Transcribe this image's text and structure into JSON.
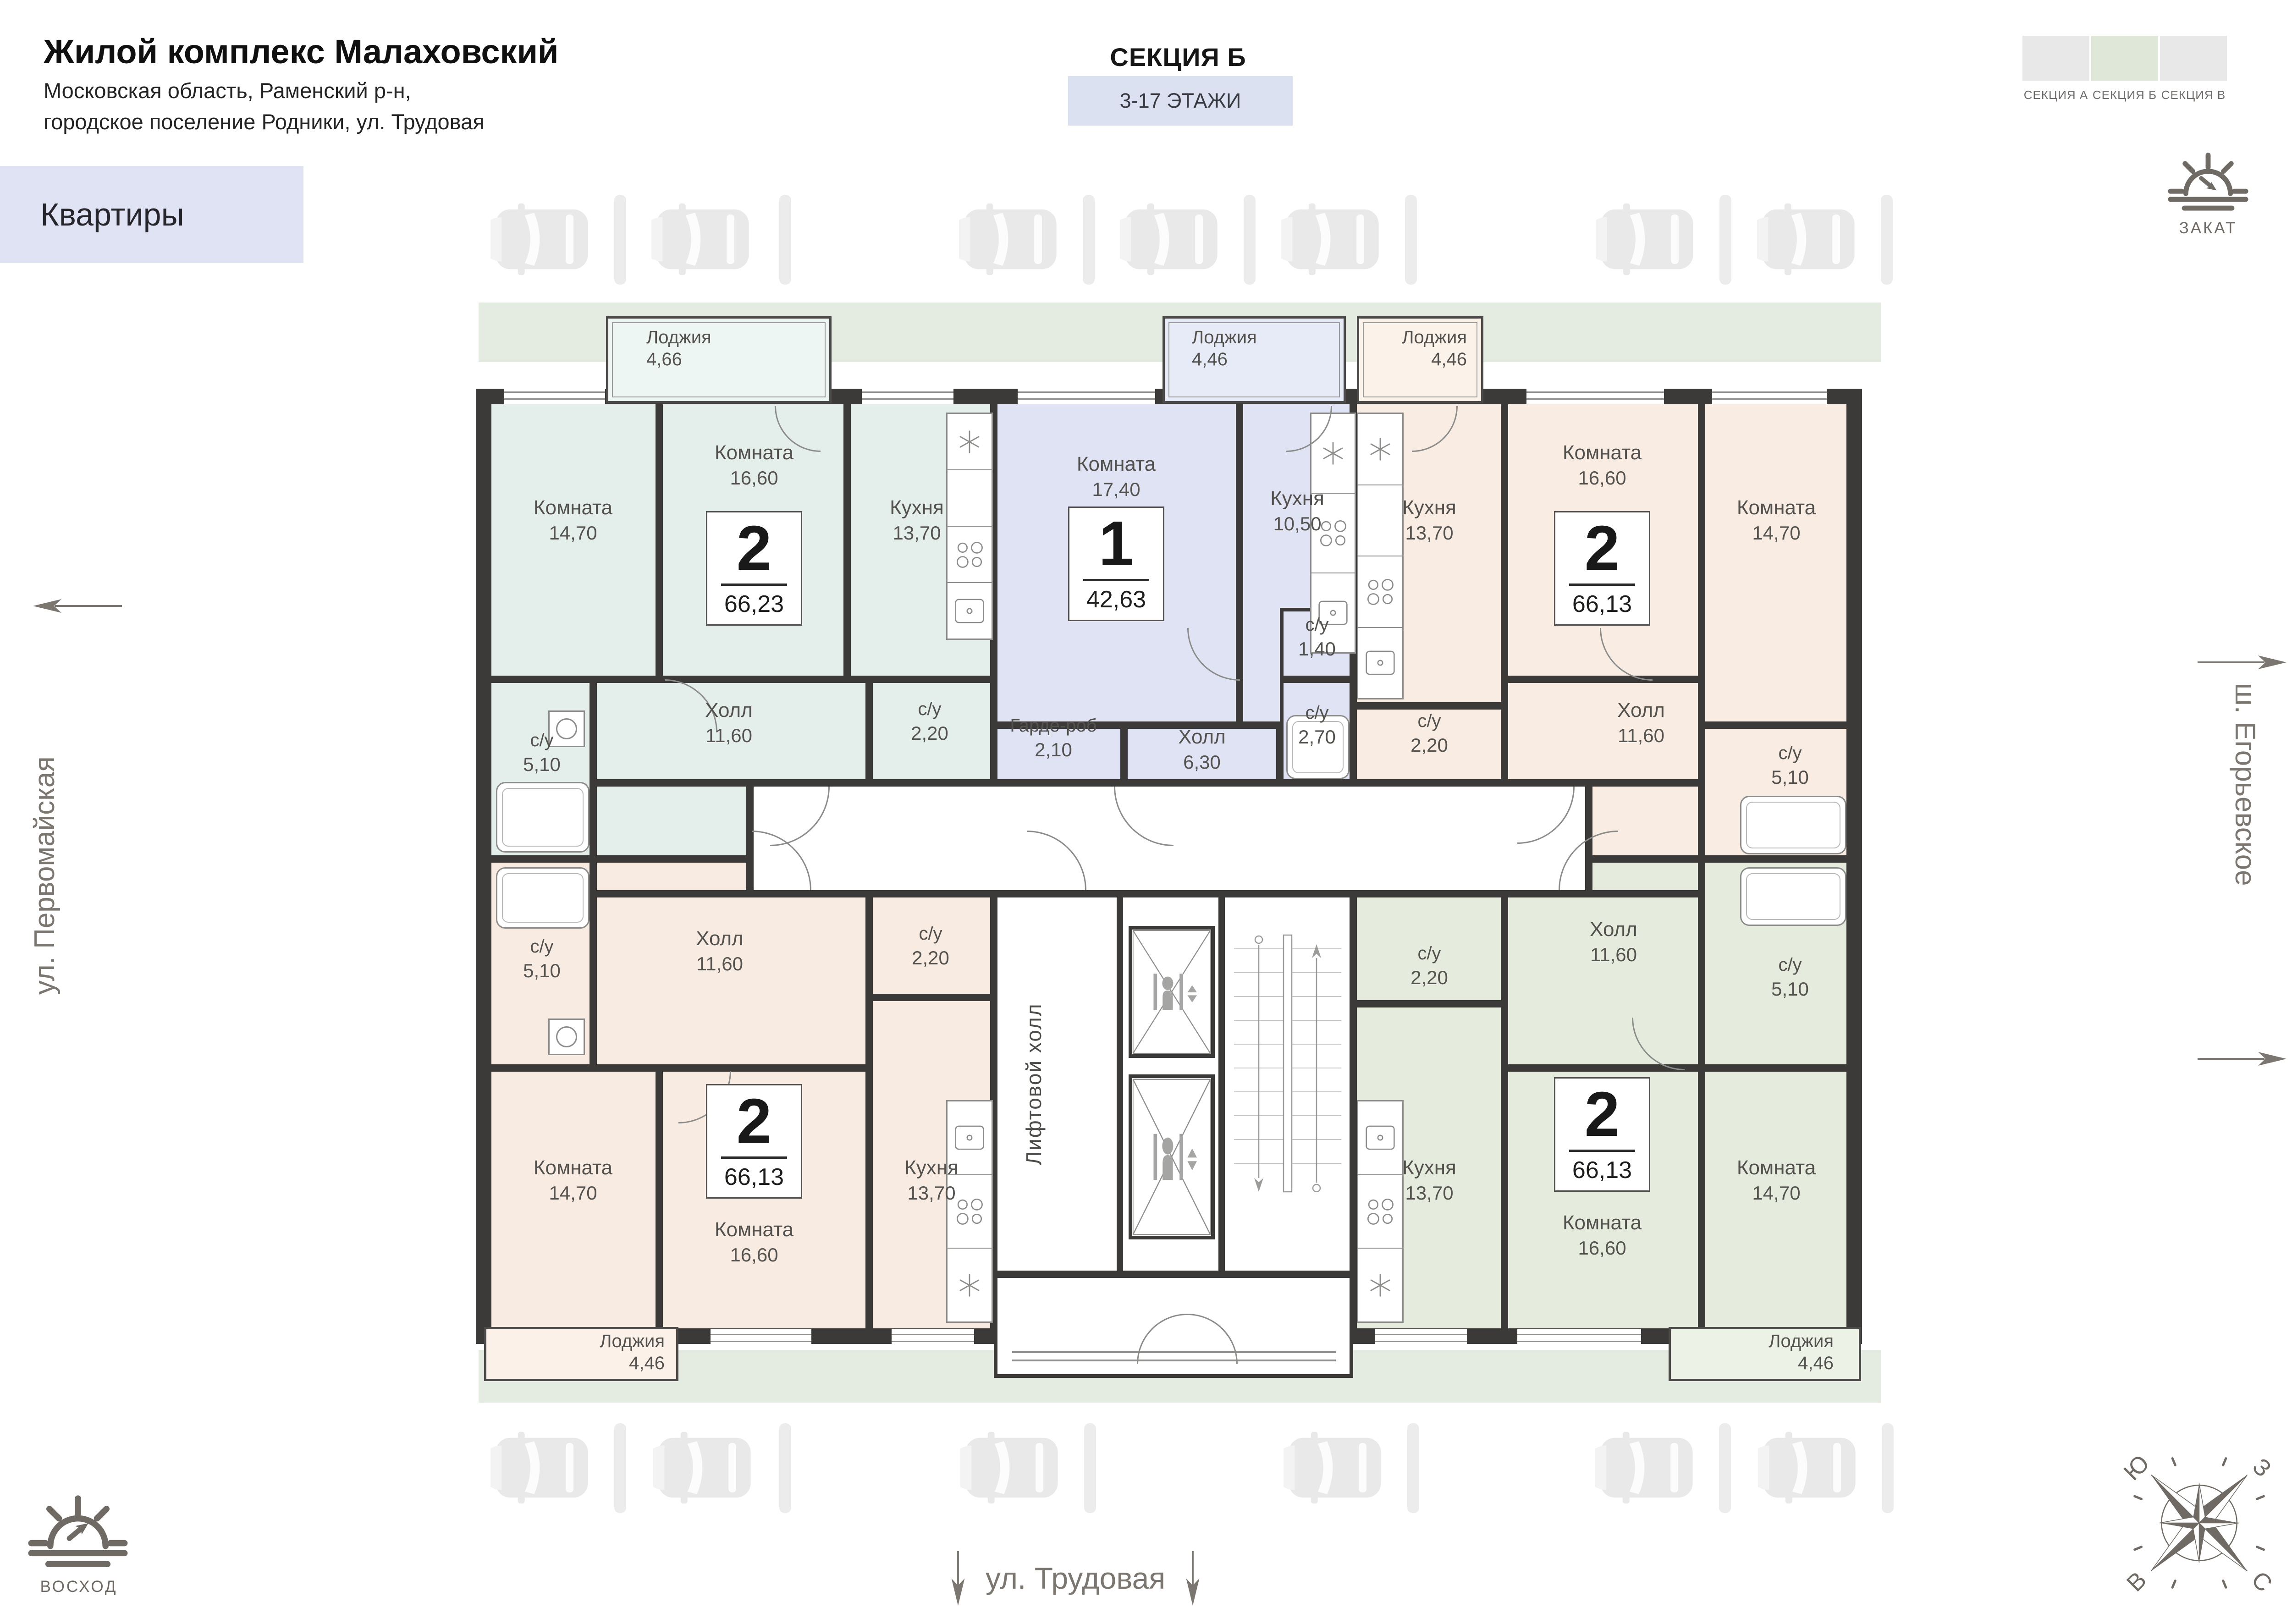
{
  "header": {
    "title": "Жилой комплекс Малаховский",
    "subtitle_line1": "Московская область, Раменский р-н,",
    "subtitle_line2": "городское поселение Родники, ул. Трудовая",
    "apartments_badge": "Квартиры",
    "section_title": "СЕКЦИЯ Б",
    "floors_badge": "3-17 ЭТАЖИ"
  },
  "section_tabs": {
    "items": [
      {
        "label": "СЕКЦИЯ А",
        "color": "#e8e8e8",
        "active": false
      },
      {
        "label": "СЕКЦИЯ Б",
        "color": "#dee7d8",
        "active": true
      },
      {
        "label": "СЕКЦИЯ В",
        "color": "#e8e8e8",
        "active": false
      }
    ]
  },
  "legend": {
    "sunset": "ЗАКАТ",
    "sunrise": "ВОСХОД"
  },
  "streets": {
    "left": "ул. Первомайская",
    "right": "ш. Егорьевское",
    "bottom": "ул. Трудовая"
  },
  "compass": {
    "north": "С",
    "south": "Ю",
    "west": "З",
    "east": "В"
  },
  "core": {
    "lift_hall": "Лифтовой холл"
  },
  "colors": {
    "wall": "#3b3a38",
    "greenery": "#e4ebe0"
  },
  "apartments": [
    {
      "key": "a",
      "type": "2",
      "total_area": "66,23",
      "color": "#e4efec",
      "loggia_color": "#eef6f3",
      "loggia": {
        "name": "Лоджия",
        "area": "4,66"
      },
      "rooms": [
        {
          "name": "Комната",
          "area": "14,70"
        },
        {
          "name": "Комната",
          "area": "16,60"
        },
        {
          "name": "Кухня",
          "area": "13,70"
        },
        {
          "name": "Холл",
          "area": "11,60"
        },
        {
          "name": "с/у",
          "area": "5,10"
        },
        {
          "name": "с/у",
          "area": "2,20"
        }
      ]
    },
    {
      "key": "b",
      "type": "1",
      "total_area": "42,63",
      "color": "#dfe3f4",
      "loggia_color": "#e7ebf7",
      "loggia": {
        "name": "Лоджия",
        "area": "4,46"
      },
      "rooms": [
        {
          "name": "Комната",
          "area": "17,40"
        },
        {
          "name": "Кухня",
          "area": "10,50"
        },
        {
          "name": "Гарде-роб",
          "area": "2,10"
        },
        {
          "name": "Холл",
          "area": "6,30"
        },
        {
          "name": "с/у",
          "area": "1,40"
        },
        {
          "name": "с/у",
          "area": "2,70"
        }
      ]
    },
    {
      "key": "c",
      "type": "2",
      "total_area": "66,13",
      "color": "#f8ece3",
      "loggia_color": "#fbf2ea",
      "loggia": {
        "name": "Лоджия",
        "area": "4,46"
      },
      "rooms": [
        {
          "name": "Кухня",
          "area": "13,70"
        },
        {
          "name": "Комната",
          "area": "16,60"
        },
        {
          "name": "Комната",
          "area": "14,70"
        },
        {
          "name": "с/у",
          "area": "2,20"
        },
        {
          "name": "Холл",
          "area": "11,60"
        },
        {
          "name": "с/у",
          "area": "5,10"
        }
      ]
    },
    {
      "key": "d",
      "type": "2",
      "total_area": "66,13",
      "color": "#f8ebe2",
      "loggia_color": "#fbf1e9",
      "loggia": {
        "name": "Лоджия",
        "area": "4,46"
      },
      "rooms": [
        {
          "name": "с/у",
          "area": "5,10"
        },
        {
          "name": "Холл",
          "area": "11,60"
        },
        {
          "name": "с/у",
          "area": "2,20"
        },
        {
          "name": "Комната",
          "area": "14,70"
        },
        {
          "name": "Комната",
          "area": "16,60"
        },
        {
          "name": "Кухня",
          "area": "13,70"
        }
      ]
    },
    {
      "key": "e",
      "type": "2",
      "total_area": "66,13",
      "color": "#e5ecdd",
      "loggia_color": "#edf2e6",
      "loggia": {
        "name": "Лоджия",
        "area": "4,46"
      },
      "rooms": [
        {
          "name": "Холл",
          "area": "11,60"
        },
        {
          "name": "с/у",
          "area": "2,20"
        },
        {
          "name": "с/у",
          "area": "5,10"
        },
        {
          "name": "Кухня",
          "area": "13,70"
        },
        {
          "name": "Комната",
          "area": "16,60"
        },
        {
          "name": "Комната",
          "area": "14,70"
        }
      ]
    }
  ]
}
